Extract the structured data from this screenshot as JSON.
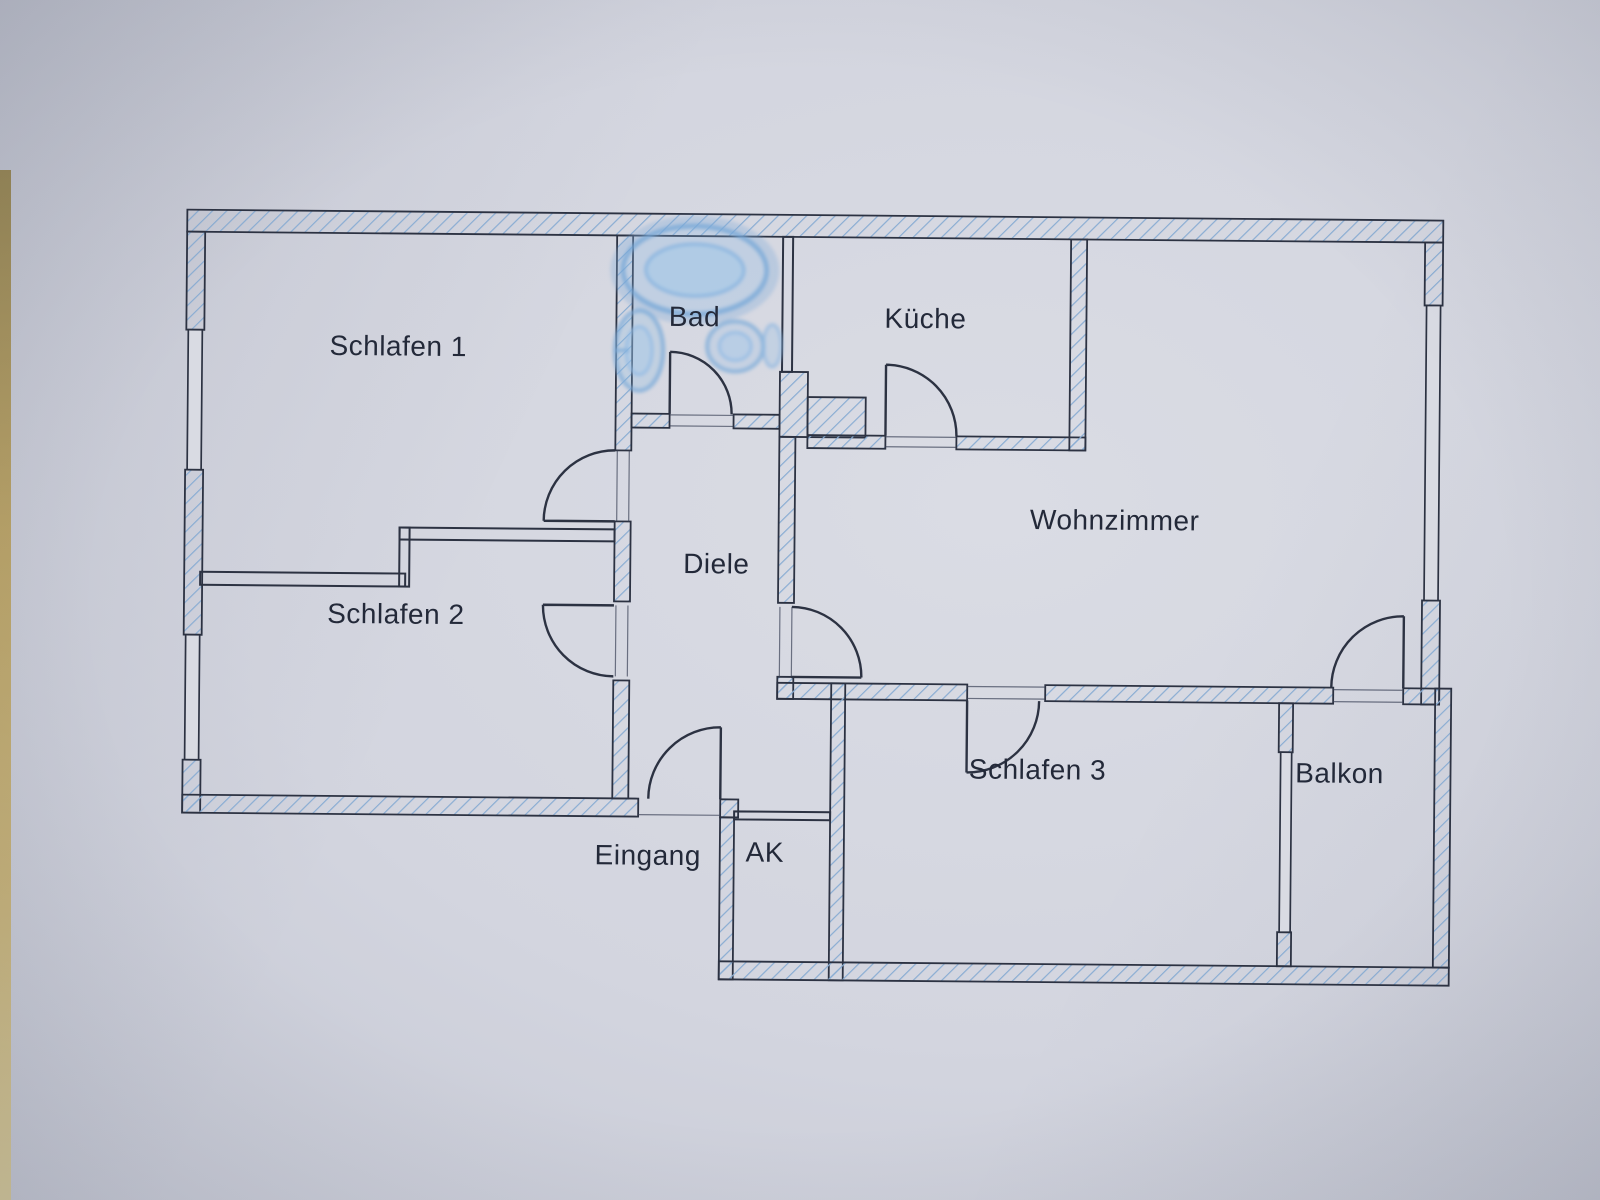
{
  "document": {
    "kind": "apartment-floor-plan",
    "language": "de"
  },
  "rooms": [
    {
      "id": "schlafen-1",
      "label": "Schlafen 1"
    },
    {
      "id": "schlafen-2",
      "label": "Schlafen 2"
    },
    {
      "id": "schlafen-3",
      "label": "Schlafen 3"
    },
    {
      "id": "bad",
      "label": "Bad"
    },
    {
      "id": "kueche",
      "label": "Küche"
    },
    {
      "id": "wohnzimmer",
      "label": "Wohnzimmer"
    },
    {
      "id": "diele",
      "label": "Diele"
    },
    {
      "id": "balkon",
      "label": "Balkon"
    },
    {
      "id": "eingang",
      "label": "Eingang"
    },
    {
      "id": "ak",
      "label": "AK"
    }
  ],
  "fixtures": [
    {
      "name": "bathtub"
    },
    {
      "name": "washbasin"
    },
    {
      "name": "toilet"
    }
  ],
  "colors": {
    "paper": "#d4d6df",
    "wall_line": "#2c3242",
    "hatch": "#8aadd3",
    "fixture": "#77a9d9",
    "text": "#232939",
    "edge_strip": "#b49a55"
  }
}
